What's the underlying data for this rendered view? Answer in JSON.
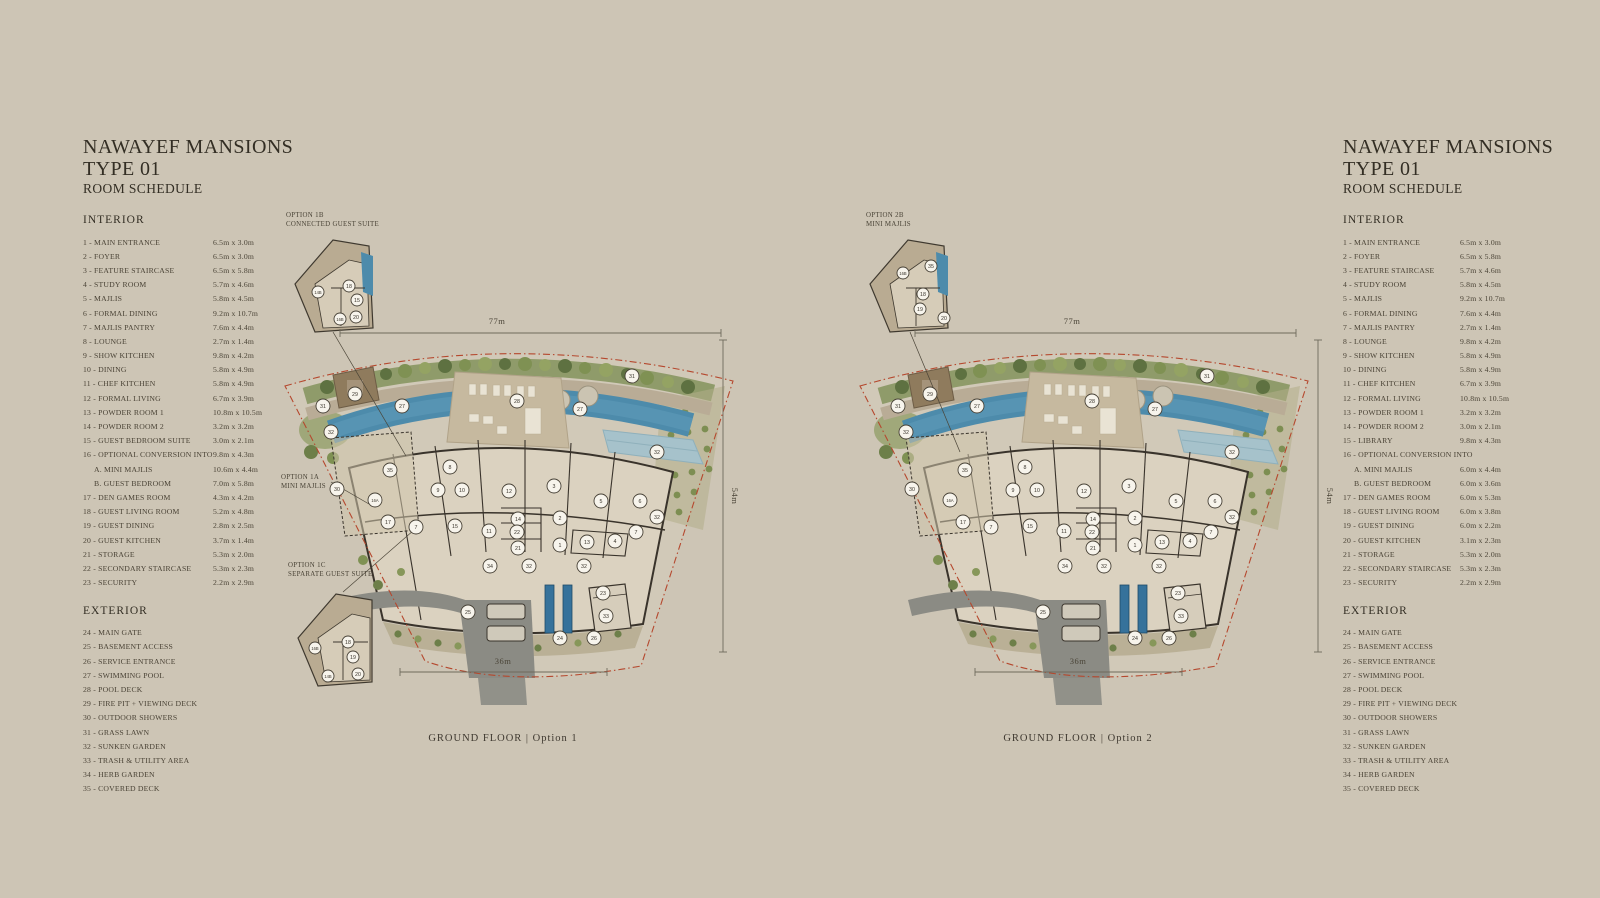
{
  "page": {
    "background": "#cdc5b5"
  },
  "schedules": {
    "left": {
      "title_line1": "NAWAYEF MANSIONS",
      "title_line2": "TYPE 01",
      "subtitle": "ROOM SCHEDULE",
      "interior_header": "INTERIOR",
      "exterior_header": "EXTERIOR",
      "interior": [
        {
          "name": "1 - MAIN ENTRANCE",
          "dims": "6.5m x 3.0m"
        },
        {
          "name": "2 - FOYER",
          "dims": "6.5m x 3.0m"
        },
        {
          "name": "3 - FEATURE STAIRCASE",
          "dims": "6.5m x 5.8m"
        },
        {
          "name": "4 - STUDY ROOM",
          "dims": "5.7m x 4.6m"
        },
        {
          "name": "5 - MAJLIS",
          "dims": "5.8m x 4.5m"
        },
        {
          "name": "6 - FORMAL DINING",
          "dims": "9.2m x 10.7m"
        },
        {
          "name": "7 - MAJLIS PANTRY",
          "dims": "7.6m x 4.4m"
        },
        {
          "name": "8 - LOUNGE",
          "dims": "2.7m x 1.4m"
        },
        {
          "name": "9 - SHOW KITCHEN",
          "dims": "9.8m x 4.2m"
        },
        {
          "name": "10 - DINING",
          "dims": "5.8m x 4.9m"
        },
        {
          "name": "11 - CHEF KITCHEN",
          "dims": "5.8m x 4.9m"
        },
        {
          "name": "12 - FORMAL LIVING",
          "dims": "6.7m x 3.9m"
        },
        {
          "name": "13 - POWDER ROOM 1",
          "dims": "10.8m x 10.5m"
        },
        {
          "name": "14 - POWDER ROOM 2",
          "dims": "3.2m x 3.2m"
        },
        {
          "name": "15 - GUEST BEDROOM SUITE",
          "dims": "3.0m x 2.1m"
        },
        {
          "name": "16 - OPTIONAL CONVERSION INTO",
          "dims": "9.8m x 4.3m"
        },
        {
          "name": "A. MINI MAJLIS",
          "dims": "10.6m x 4.4m",
          "indent": true
        },
        {
          "name": "B. GUEST BEDROOM",
          "dims": "7.0m x 5.8m",
          "indent": true
        },
        {
          "name": "17 - DEN GAMES ROOM",
          "dims": "4.3m x 4.2m"
        },
        {
          "name": "18 - GUEST LIVING ROOM",
          "dims": "5.2m x 4.8m"
        },
        {
          "name": "19 - GUEST DINING",
          "dims": "2.8m x 2.5m"
        },
        {
          "name": "20 - GUEST KITCHEN",
          "dims": "3.7m x 1.4m"
        },
        {
          "name": "21 - STORAGE",
          "dims": "5.3m x 2.0m"
        },
        {
          "name": "22 - SECONDARY STAIRCASE",
          "dims": "5.3m x 2.3m"
        },
        {
          "name": "23 - SECURITY",
          "dims": "2.2m x 2.9m"
        }
      ],
      "exterior": [
        {
          "name": "24 - MAIN GATE"
        },
        {
          "name": "25 - BASEMENT ACCESS"
        },
        {
          "name": "26 - SERVICE ENTRANCE"
        },
        {
          "name": "27 - SWIMMING POOL"
        },
        {
          "name": "28 - POOL DECK"
        },
        {
          "name": "29 - FIRE PIT + VIEWING DECK"
        },
        {
          "name": "30 - OUTDOOR SHOWERS"
        },
        {
          "name": "31 - GRASS LAWN"
        },
        {
          "name": "32 - SUNKEN GARDEN"
        },
        {
          "name": "33 - TRASH & UTILITY AREA"
        },
        {
          "name": "34 - HERB GARDEN"
        },
        {
          "name": "35 - COVERED DECK"
        }
      ]
    },
    "right": {
      "title_line1": "NAWAYEF MANSIONS",
      "title_line2": "TYPE 01",
      "subtitle": "ROOM SCHEDULE",
      "interior_header": "INTERIOR",
      "exterior_header": "EXTERIOR",
      "interior": [
        {
          "name": "1 - MAIN ENTRANCE",
          "dims": "6.5m x 3.0m"
        },
        {
          "name": "2 - FOYER",
          "dims": "6.5m x 5.8m"
        },
        {
          "name": "3 - FEATURE STAIRCASE",
          "dims": "5.7m x 4.6m"
        },
        {
          "name": "4 - STUDY ROOM",
          "dims": "5.8m x 4.5m"
        },
        {
          "name": "5 - MAJLIS",
          "dims": "9.2m x 10.7m"
        },
        {
          "name": "6 - FORMAL DINING",
          "dims": "7.6m x 4.4m"
        },
        {
          "name": "7 - MAJLIS PANTRY",
          "dims": "2.7m x 1.4m"
        },
        {
          "name": "8 - LOUNGE",
          "dims": "9.8m x 4.2m"
        },
        {
          "name": "9 - SHOW KITCHEN",
          "dims": "5.8m x 4.9m"
        },
        {
          "name": "10 - DINING",
          "dims": "5.8m x 4.9m"
        },
        {
          "name": "11 - CHEF KITCHEN",
          "dims": "6.7m x 3.9m"
        },
        {
          "name": "12 - FORMAL LIVING",
          "dims": "10.8m x 10.5m"
        },
        {
          "name": "13 - POWDER ROOM 1",
          "dims": "3.2m x 3.2m"
        },
        {
          "name": "14 - POWDER ROOM 2",
          "dims": "3.0m x 2.1m"
        },
        {
          "name": "15 - LIBRARY",
          "dims": "9.8m x 4.3m"
        },
        {
          "name": "16 - OPTIONAL CONVERSION INTO",
          "dims": ""
        },
        {
          "name": "A. MINI MAJLIS",
          "dims": "6.0m x 4.4m",
          "indent": true
        },
        {
          "name": "B. GUEST BEDROOM",
          "dims": "6.0m x 3.6m",
          "indent": true
        },
        {
          "name": "17 - DEN GAMES ROOM",
          "dims": "6.0m x 5.3m"
        },
        {
          "name": "18 - GUEST LIVING ROOM",
          "dims": "6.0m x 3.8m"
        },
        {
          "name": "19 - GUEST DINING",
          "dims": "6.0m x 2.2m"
        },
        {
          "name": "20 - GUEST KITCHEN",
          "dims": "3.1m x 2.3m"
        },
        {
          "name": "21 - STORAGE",
          "dims": "5.3m x 2.0m"
        },
        {
          "name": "22 - SECONDARY STAIRCASE",
          "dims": "5.3m x 2.3m"
        },
        {
          "name": "23 - SECURITY",
          "dims": "2.2m x 2.9m"
        }
      ],
      "exterior": [
        {
          "name": "24 - MAIN GATE"
        },
        {
          "name": "25 - BASEMENT ACCESS"
        },
        {
          "name": "26 - SERVICE ENTRANCE"
        },
        {
          "name": "27 - SWIMMING POOL"
        },
        {
          "name": "28 - POOL DECK"
        },
        {
          "name": "29 - FIRE PIT + VIEWING DECK"
        },
        {
          "name": "30 - OUTDOOR SHOWERS"
        },
        {
          "name": "31 - GRASS LAWN"
        },
        {
          "name": "32 - SUNKEN GARDEN"
        },
        {
          "name": "33 - TRASH & UTILITY AREA"
        },
        {
          "name": "34 - HERB GARDEN"
        },
        {
          "name": "35 - COVERED DECK"
        }
      ]
    }
  },
  "plans": [
    {
      "caption": "GROUND FLOOR | Option 1",
      "dim_top": "77m",
      "dim_right": "54m",
      "dim_bottom": "36m",
      "options": {
        "b_line1": "OPTION 1B",
        "b_line2": "CONNECTED GUEST SUITE",
        "a_line1": "OPTION 1A",
        "a_line2": "MINI MAJLIS",
        "c_line1": "OPTION 1C",
        "c_line2": "SEPARATE GUEST SUITE"
      },
      "markers": [
        {
          "n": "29",
          "x": 82,
          "y": 194
        },
        {
          "n": "31",
          "x": 50,
          "y": 206
        },
        {
          "n": "27",
          "x": 129,
          "y": 206
        },
        {
          "n": "32",
          "x": 58,
          "y": 232
        },
        {
          "n": "28",
          "x": 244,
          "y": 201
        },
        {
          "n": "27",
          "x": 307,
          "y": 209
        },
        {
          "n": "31",
          "x": 359,
          "y": 176
        },
        {
          "n": "32",
          "x": 384,
          "y": 252
        },
        {
          "n": "35",
          "x": 117,
          "y": 270
        },
        {
          "n": "8",
          "x": 177,
          "y": 267
        },
        {
          "n": "9",
          "x": 165,
          "y": 290
        },
        {
          "n": "10",
          "x": 189,
          "y": 290
        },
        {
          "n": "12",
          "x": 236,
          "y": 291
        },
        {
          "n": "3",
          "x": 281,
          "y": 286
        },
        {
          "n": "16A",
          "x": 102,
          "y": 300
        },
        {
          "n": "5",
          "x": 328,
          "y": 301
        },
        {
          "n": "6",
          "x": 367,
          "y": 301
        },
        {
          "n": "30",
          "x": 64,
          "y": 289
        },
        {
          "n": "17",
          "x": 115,
          "y": 322
        },
        {
          "n": "7",
          "x": 143,
          "y": 327
        },
        {
          "n": "15",
          "x": 182,
          "y": 326
        },
        {
          "n": "11",
          "x": 216,
          "y": 331
        },
        {
          "n": "14",
          "x": 245,
          "y": 319
        },
        {
          "n": "22",
          "x": 244,
          "y": 332
        },
        {
          "n": "21",
          "x": 245,
          "y": 348
        },
        {
          "n": "2",
          "x": 287,
          "y": 318
        },
        {
          "n": "1",
          "x": 287,
          "y": 345
        },
        {
          "n": "13",
          "x": 314,
          "y": 342
        },
        {
          "n": "4",
          "x": 342,
          "y": 341
        },
        {
          "n": "7",
          "x": 363,
          "y": 332
        },
        {
          "n": "32",
          "x": 384,
          "y": 317
        },
        {
          "n": "34",
          "x": 217,
          "y": 366
        },
        {
          "n": "32",
          "x": 256,
          "y": 366
        },
        {
          "n": "32",
          "x": 311,
          "y": 366
        },
        {
          "n": "25",
          "x": 195,
          "y": 412
        },
        {
          "n": "23",
          "x": 330,
          "y": 393
        },
        {
          "n": "33",
          "x": 333,
          "y": 416
        },
        {
          "n": "24",
          "x": 287,
          "y": 438
        },
        {
          "n": "26",
          "x": 321,
          "y": 438
        }
      ],
      "inset_b_markers": [
        {
          "n": "14B",
          "x": 45,
          "y": 92
        },
        {
          "n": "18",
          "x": 76,
          "y": 86
        },
        {
          "n": "15",
          "x": 84,
          "y": 100
        },
        {
          "n": "16B",
          "x": 67,
          "y": 119
        },
        {
          "n": "20",
          "x": 83,
          "y": 117
        }
      ],
      "inset_c_markers": [
        {
          "n": "16B",
          "x": 42,
          "y": 448
        },
        {
          "n": "18",
          "x": 75,
          "y": 442
        },
        {
          "n": "19",
          "x": 80,
          "y": 457
        },
        {
          "n": "14B",
          "x": 55,
          "y": 476
        },
        {
          "n": "20",
          "x": 85,
          "y": 474
        }
      ]
    },
    {
      "caption": "GROUND FLOOR | Option 2",
      "dim_top": "77m",
      "dim_right": "54m",
      "dim_bottom": "36m",
      "options": {
        "b_line1": "OPTION 2B",
        "b_line2": "MINI MAJLIS"
      },
      "markers": [
        {
          "n": "29",
          "x": 82,
          "y": 194
        },
        {
          "n": "31",
          "x": 50,
          "y": 206
        },
        {
          "n": "27",
          "x": 129,
          "y": 206
        },
        {
          "n": "32",
          "x": 58,
          "y": 232
        },
        {
          "n": "28",
          "x": 244,
          "y": 201
        },
        {
          "n": "27",
          "x": 307,
          "y": 209
        },
        {
          "n": "31",
          "x": 359,
          "y": 176
        },
        {
          "n": "32",
          "x": 384,
          "y": 252
        },
        {
          "n": "35",
          "x": 117,
          "y": 270
        },
        {
          "n": "8",
          "x": 177,
          "y": 267
        },
        {
          "n": "9",
          "x": 165,
          "y": 290
        },
        {
          "n": "10",
          "x": 189,
          "y": 290
        },
        {
          "n": "12",
          "x": 236,
          "y": 291
        },
        {
          "n": "3",
          "x": 281,
          "y": 286
        },
        {
          "n": "16A",
          "x": 102,
          "y": 300
        },
        {
          "n": "5",
          "x": 328,
          "y": 301
        },
        {
          "n": "6",
          "x": 367,
          "y": 301
        },
        {
          "n": "30",
          "x": 64,
          "y": 289
        },
        {
          "n": "17",
          "x": 115,
          "y": 322
        },
        {
          "n": "7",
          "x": 143,
          "y": 327
        },
        {
          "n": "15",
          "x": 182,
          "y": 326
        },
        {
          "n": "11",
          "x": 216,
          "y": 331
        },
        {
          "n": "14",
          "x": 245,
          "y": 319
        },
        {
          "n": "22",
          "x": 244,
          "y": 332
        },
        {
          "n": "21",
          "x": 245,
          "y": 348
        },
        {
          "n": "2",
          "x": 287,
          "y": 318
        },
        {
          "n": "1",
          "x": 287,
          "y": 345
        },
        {
          "n": "13",
          "x": 314,
          "y": 342
        },
        {
          "n": "4",
          "x": 342,
          "y": 341
        },
        {
          "n": "7",
          "x": 363,
          "y": 332
        },
        {
          "n": "32",
          "x": 384,
          "y": 317
        },
        {
          "n": "34",
          "x": 217,
          "y": 366
        },
        {
          "n": "32",
          "x": 256,
          "y": 366
        },
        {
          "n": "32",
          "x": 311,
          "y": 366
        },
        {
          "n": "25",
          "x": 195,
          "y": 412
        },
        {
          "n": "23",
          "x": 330,
          "y": 393
        },
        {
          "n": "33",
          "x": 333,
          "y": 416
        },
        {
          "n": "24",
          "x": 287,
          "y": 438
        },
        {
          "n": "26",
          "x": 321,
          "y": 438
        }
      ],
      "inset_b_markers": [
        {
          "n": "16B",
          "x": 55,
          "y": 73
        },
        {
          "n": "35",
          "x": 83,
          "y": 66
        },
        {
          "n": "18",
          "x": 75,
          "y": 94
        },
        {
          "n": "19",
          "x": 72,
          "y": 109
        },
        {
          "n": "20",
          "x": 96,
          "y": 118
        }
      ]
    }
  ]
}
